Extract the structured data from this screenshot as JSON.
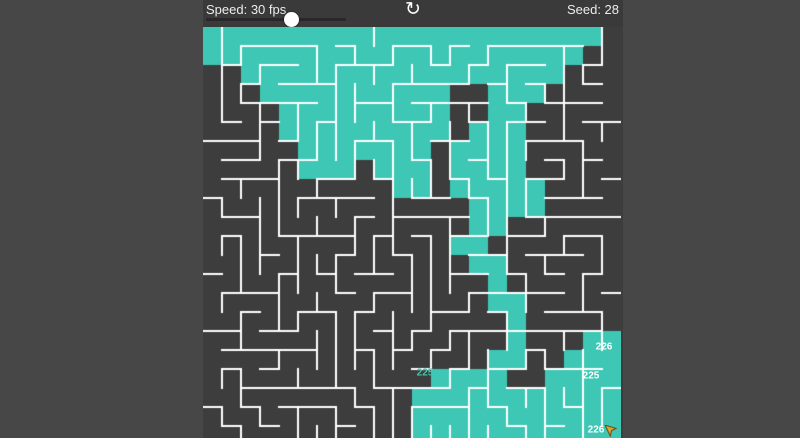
{
  "page": {
    "background_color": "#474747",
    "app_background_color": "#3a3a3a"
  },
  "toolbar": {
    "speed_label": "Speed: 30 fps",
    "seed_label": "Seed: 28",
    "refresh_icon": "↻",
    "slider": {
      "value_percent": 61
    }
  },
  "maze": {
    "seed": 28,
    "cols": 22,
    "rows": 23,
    "cell_size": 19,
    "wall_color": "#ffffff",
    "visited_color": "#3ec7b4",
    "unvisited_color": "#3d3d3d",
    "visited_map": [
      "1111111111111111111110",
      "1111111111111111111100",
      "0011111111111111111000",
      "0001111111111001110000",
      "0000111111111001100000",
      "0000111111111011100000",
      "0000011111110111100000",
      "0000011101110111100000",
      "0000000000110111110000",
      "0000000000000011110000",
      "0000000000000011000000",
      "0000000000000110000000",
      "0000000000000011000000",
      "0000000000000001000000",
      "0000000000000001100000",
      "0000000000000000100000",
      "0000000000000000100011",
      "0000000000000001100111",
      "0000000000001111001111",
      "0000000000011111111111",
      "0000000000011111111111",
      "0000000000011111111111",
      "0000000000011111111111"
    ],
    "labels": [
      {
        "text": "226",
        "x": 401,
        "y": 320,
        "color": "#ffffff"
      },
      {
        "text": "225",
        "x": 222,
        "y": 346,
        "color": "#3ec7b4"
      },
      {
        "text": "225",
        "x": 388,
        "y": 349,
        "color": "#ffffff"
      },
      {
        "text": "226",
        "x": 393,
        "y": 403,
        "color": "#ffffff"
      }
    ],
    "cursor": {
      "x": 409,
      "y": 403,
      "fill": "#d4a437",
      "outline": "#6b4f17"
    }
  }
}
